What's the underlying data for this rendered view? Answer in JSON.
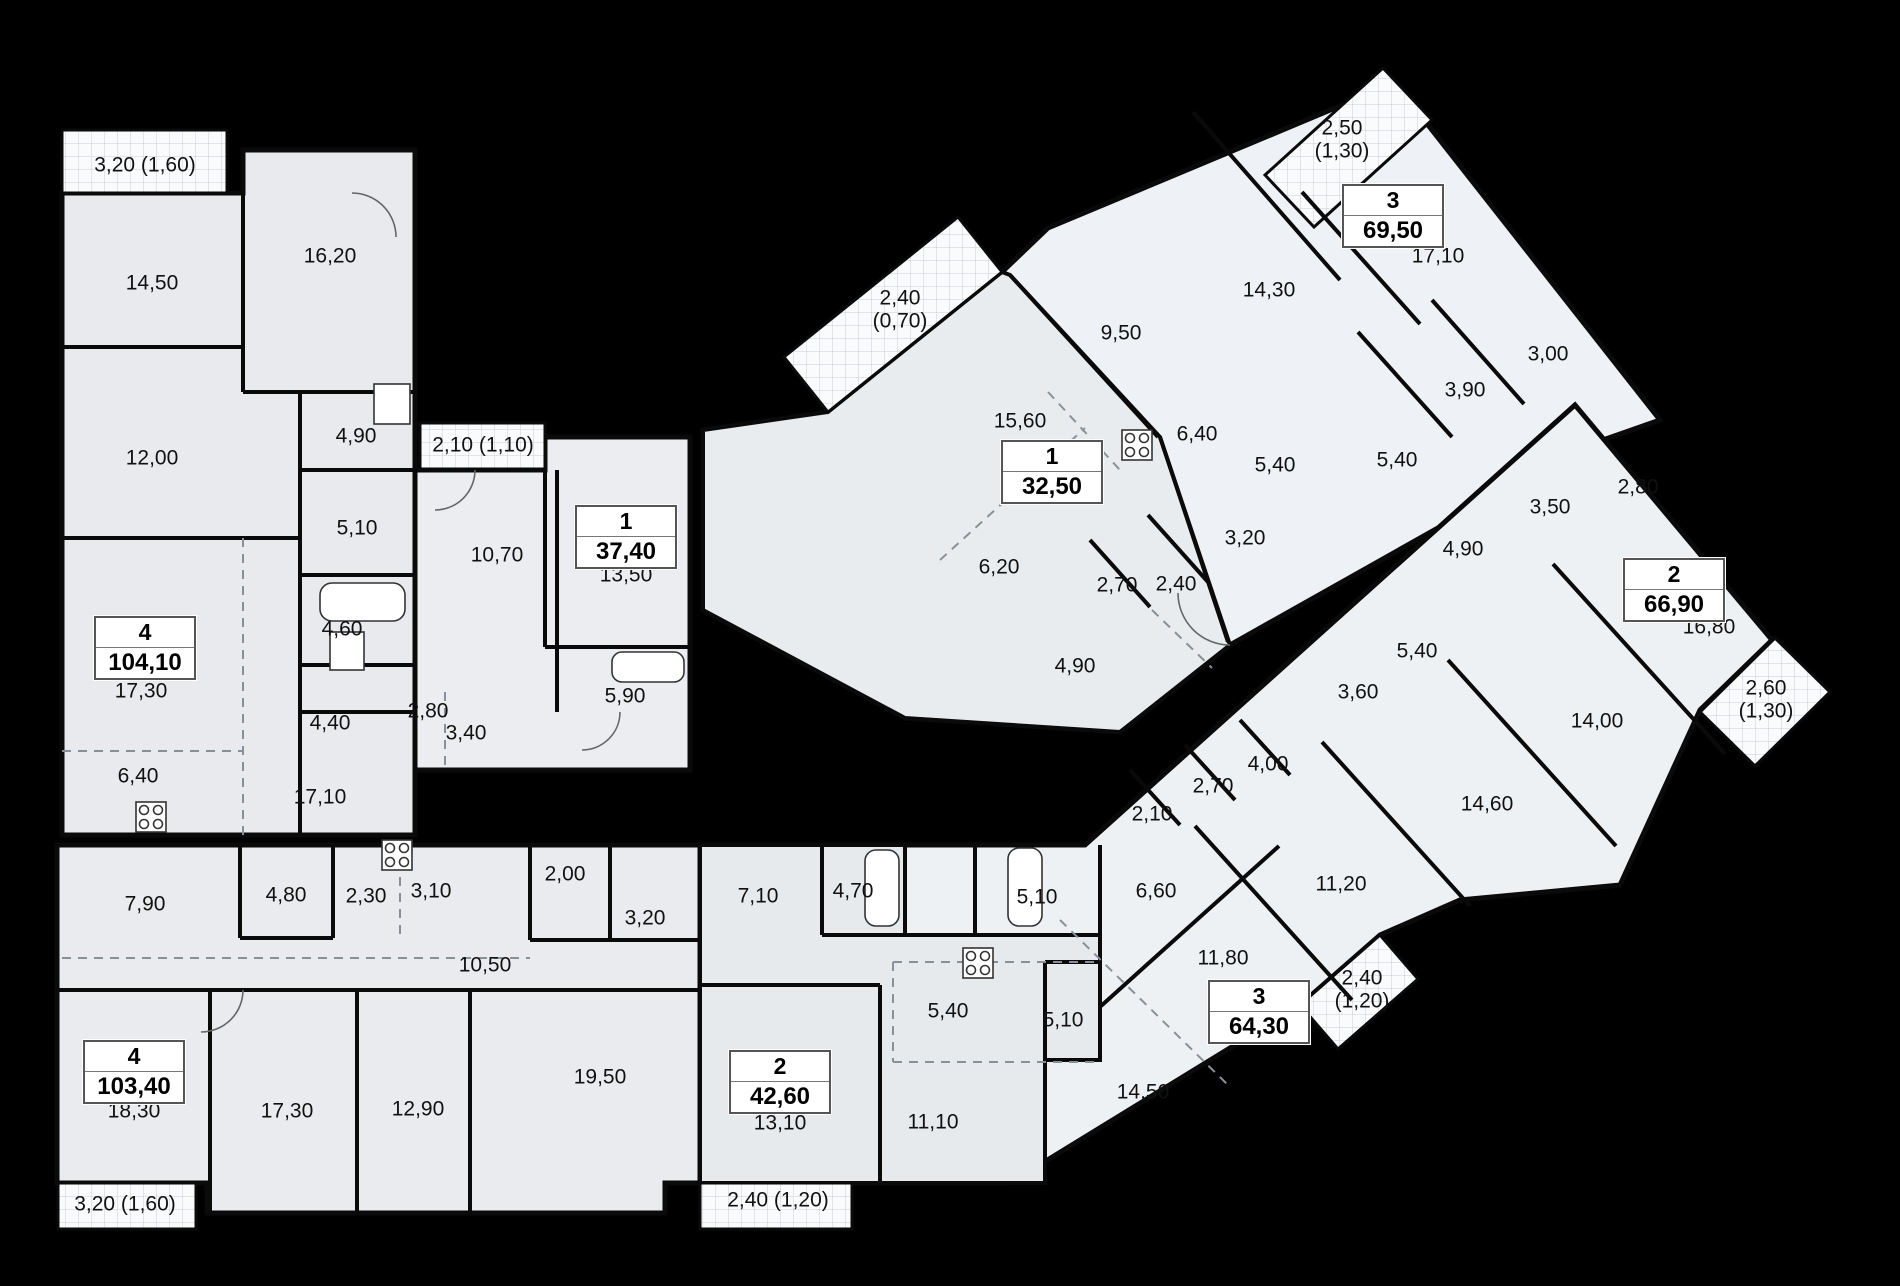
{
  "plan": {
    "type": "residential-floor-plan",
    "units": "m2",
    "apartments": [
      {
        "number": "4",
        "total_area": "104,10",
        "rooms": [
          "14,50",
          "16,20",
          "12,00",
          "4,90",
          "5,10",
          "4,60",
          "4,40",
          "17,30",
          "6,40",
          "17,10"
        ],
        "balconies": [
          "3,20 (1,60)"
        ]
      },
      {
        "number": "1",
        "total_area": "37,40",
        "rooms": [
          "13,50",
          "10,70",
          "5,90",
          "2,80",
          "3,40"
        ],
        "balconies": [
          "2,10 (1,10)"
        ]
      },
      {
        "number": "4",
        "total_area": "103,40",
        "rooms": [
          "18,30",
          "17,30",
          "12,90",
          "19,50",
          "10,50",
          "7,90",
          "4,80",
          "2,30",
          "3,10",
          "2,00",
          "3,20"
        ],
        "balconies": [
          "3,20 (1,60)"
        ]
      },
      {
        "number": "2",
        "total_area": "42,60",
        "rooms": [
          "13,10",
          "11,10",
          "7,10",
          "4,70",
          "5,10",
          "5,40",
          "5,10"
        ],
        "balconies": [
          "2,40 (1,20)"
        ]
      },
      {
        "number": "3",
        "total_area": "64,30",
        "rooms": [
          "14,50",
          "11,80",
          "11,20",
          "6,60",
          "2,10",
          "2,70",
          "4,00"
        ],
        "balconies": [
          "2,40 (1,20)"
        ]
      },
      {
        "number": "1",
        "total_area": "32,50",
        "rooms": [
          "15,60",
          "6,20",
          "4,90",
          "2,70",
          "2,40"
        ],
        "balconies": [
          "2,40 (0,70)"
        ]
      },
      {
        "number": "3",
        "total_area": "69,50",
        "rooms": [
          "17,10",
          "14,30",
          "9,50",
          "6,40",
          "5,40",
          "3,20",
          "5,40",
          "3,90",
          "3,00"
        ],
        "balconies": [
          "2,50 (1,30)"
        ]
      },
      {
        "number": "2",
        "total_area": "66,90",
        "rooms": [
          "16,80",
          "14,00",
          "14,60",
          "5,40",
          "3,60",
          "4,90",
          "3,50",
          "2,80"
        ],
        "balconies": [
          "2,60 (1,30)"
        ]
      }
    ]
  },
  "palette": {
    "background": "#000000",
    "wall": "#0a0a0a",
    "room_fill_a": "#e8eaee",
    "room_fill_b": "#eef1f5",
    "room_fill_c": "#e9ecef",
    "balcony_grid": "#c8cdd3",
    "text": "#111111"
  },
  "labels": [
    {
      "t": "3,20 (1,60)",
      "x": 145,
      "y": 166
    },
    {
      "t": "14,50",
      "x": 152,
      "y": 284
    },
    {
      "t": "16,20",
      "x": 330,
      "y": 257
    },
    {
      "t": "12,00",
      "x": 152,
      "y": 459
    },
    {
      "t": "4,90",
      "x": 356,
      "y": 437
    },
    {
      "t": "5,10",
      "x": 357,
      "y": 529
    },
    {
      "t": "4,60",
      "x": 342,
      "y": 630
    },
    {
      "t": "17,30",
      "x": 141,
      "y": 692
    },
    {
      "t": "4,40",
      "x": 330,
      "y": 724
    },
    {
      "t": "2,80",
      "x": 428,
      "y": 712
    },
    {
      "t": "3,40",
      "x": 466,
      "y": 734
    },
    {
      "t": "6,40",
      "x": 138,
      "y": 777
    },
    {
      "t": "17,10",
      "x": 320,
      "y": 798
    },
    {
      "t": "2,10 (1,10)",
      "x": 483,
      "y": 446
    },
    {
      "t": "10,70",
      "x": 497,
      "y": 556
    },
    {
      "t": "13,50",
      "x": 626,
      "y": 576
    },
    {
      "t": "5,90",
      "x": 625,
      "y": 697
    },
    {
      "t": "7,90",
      "x": 145,
      "y": 905
    },
    {
      "t": "4,80",
      "x": 286,
      "y": 896
    },
    {
      "t": "2,30",
      "x": 366,
      "y": 897
    },
    {
      "t": "3,10",
      "x": 431,
      "y": 892
    },
    {
      "t": "2,00",
      "x": 565,
      "y": 875
    },
    {
      "t": "3,20",
      "x": 645,
      "y": 919
    },
    {
      "t": "10,50",
      "x": 485,
      "y": 966
    },
    {
      "t": "18,30",
      "x": 134,
      "y": 1112
    },
    {
      "t": "17,30",
      "x": 287,
      "y": 1112
    },
    {
      "t": "12,90",
      "x": 418,
      "y": 1110
    },
    {
      "t": "19,50",
      "x": 600,
      "y": 1078
    },
    {
      "t": "3,20 (1,60)",
      "x": 125,
      "y": 1205
    },
    {
      "t": "7,10",
      "x": 758,
      "y": 897
    },
    {
      "t": "4,70",
      "x": 853,
      "y": 892
    },
    {
      "t": "5,10",
      "x": 1037,
      "y": 898
    },
    {
      "t": "5,40",
      "x": 948,
      "y": 1012
    },
    {
      "t": "5,10",
      "x": 1063,
      "y": 1021
    },
    {
      "t": "13,10",
      "x": 780,
      "y": 1124
    },
    {
      "t": "11,10",
      "x": 933,
      "y": 1123
    },
    {
      "t": "2,40 (1,20)",
      "x": 778,
      "y": 1201
    },
    {
      "t": "2,40\n(0,70)",
      "x": 900,
      "y": 310
    },
    {
      "t": "15,60",
      "x": 1020,
      "y": 422
    },
    {
      "t": "6,20",
      "x": 999,
      "y": 568
    },
    {
      "t": "2,70",
      "x": 1117,
      "y": 586
    },
    {
      "t": "2,40",
      "x": 1176,
      "y": 585
    },
    {
      "t": "4,90",
      "x": 1075,
      "y": 667
    },
    {
      "t": "9,50",
      "x": 1121,
      "y": 334
    },
    {
      "t": "14,30",
      "x": 1269,
      "y": 291
    },
    {
      "t": "2,50\n(1,30)",
      "x": 1342,
      "y": 140
    },
    {
      "t": "17,10",
      "x": 1438,
      "y": 257
    },
    {
      "t": "6,40",
      "x": 1197,
      "y": 435
    },
    {
      "t": "5,40",
      "x": 1275,
      "y": 466
    },
    {
      "t": "3,20",
      "x": 1245,
      "y": 539
    },
    {
      "t": "3,00",
      "x": 1548,
      "y": 355
    },
    {
      "t": "3,90",
      "x": 1465,
      "y": 391
    },
    {
      "t": "5,40",
      "x": 1397,
      "y": 461
    },
    {
      "t": "2,80",
      "x": 1638,
      "y": 488
    },
    {
      "t": "3,50",
      "x": 1550,
      "y": 508
    },
    {
      "t": "4,90",
      "x": 1463,
      "y": 550
    },
    {
      "t": "16,80",
      "x": 1709,
      "y": 628
    },
    {
      "t": "5,40",
      "x": 1417,
      "y": 652
    },
    {
      "t": "3,60",
      "x": 1358,
      "y": 693
    },
    {
      "t": "14,00",
      "x": 1597,
      "y": 722
    },
    {
      "t": "14,60",
      "x": 1487,
      "y": 805
    },
    {
      "t": "2,60\n(1,30)",
      "x": 1766,
      "y": 700
    },
    {
      "t": "2,10",
      "x": 1152,
      "y": 815
    },
    {
      "t": "2,70",
      "x": 1213,
      "y": 787
    },
    {
      "t": "4,00",
      "x": 1268,
      "y": 765
    },
    {
      "t": "6,60",
      "x": 1156,
      "y": 892
    },
    {
      "t": "11,80",
      "x": 1223,
      "y": 959
    },
    {
      "t": "11,20",
      "x": 1341,
      "y": 885
    },
    {
      "t": "14,50",
      "x": 1143,
      "y": 1093
    },
    {
      "t": "2,40\n(1,20)",
      "x": 1362,
      "y": 990
    }
  ],
  "apt_boxes": [
    {
      "num": "4",
      "area": "104,10",
      "x": 145,
      "y": 648
    },
    {
      "num": "1",
      "area": "37,40",
      "x": 626,
      "y": 537
    },
    {
      "num": "4",
      "area": "103,40",
      "x": 134,
      "y": 1072
    },
    {
      "num": "2",
      "area": "42,60",
      "x": 780,
      "y": 1082
    },
    {
      "num": "3",
      "area": "64,30",
      "x": 1259,
      "y": 1012
    },
    {
      "num": "1",
      "area": "32,50",
      "x": 1052,
      "y": 472
    },
    {
      "num": "3",
      "area": "69,50",
      "x": 1393,
      "y": 216
    },
    {
      "num": "2",
      "area": "66,90",
      "x": 1674,
      "y": 590
    }
  ]
}
